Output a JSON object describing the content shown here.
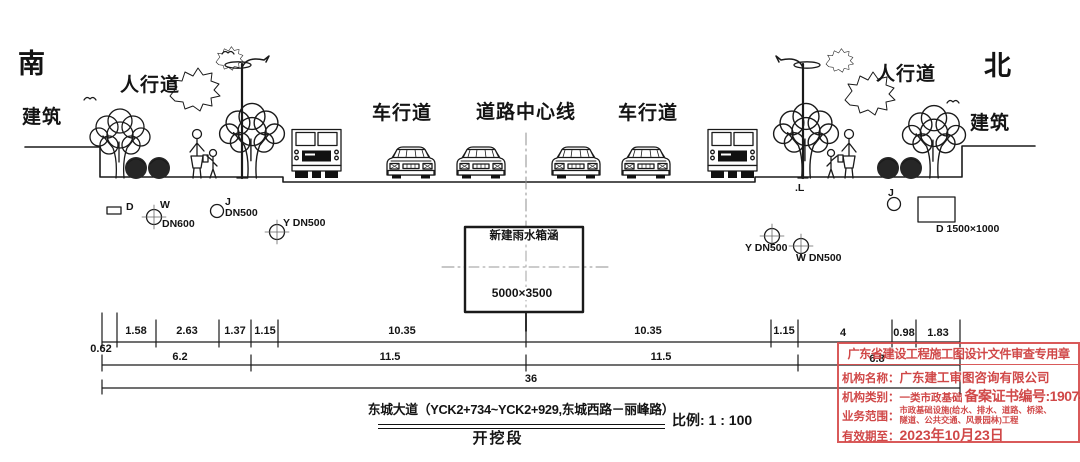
{
  "compass": {
    "south": "南",
    "north": "北"
  },
  "section_labels": {
    "building_left": "建筑",
    "sidewalk_left": "人行道",
    "roadway_left": "车行道",
    "road_centerline": "道路中心线",
    "roadway_right": "车行道",
    "sidewalk_right": "人行道",
    "building_right": "建筑"
  },
  "culvert": {
    "name": "新建雨水箱涵",
    "size": "5000×3500"
  },
  "utilities": {
    "left": {
      "d_label": "D",
      "w_label": "W",
      "w_size": "DN600",
      "j_label": "J",
      "j_size": "DN500",
      "y_label": "Y DN500"
    },
    "right": {
      "l_label": ".L",
      "y_label": "Y DN500",
      "w_label": "W DN500",
      "j_label": "J",
      "d_label": "D 1500×1000"
    }
  },
  "dimensions": {
    "row1": [
      "0.62",
      "1.58",
      "2.63",
      "1.37",
      "1.15",
      "10.35",
      "10.35",
      "1.15",
      "4",
      "0.98",
      "1.83"
    ],
    "row2": [
      "6.2",
      "11.5",
      "11.5",
      "6.8"
    ],
    "row3": [
      "36"
    ]
  },
  "title_block": {
    "title": "东城大道（YCK2+734~YCK2+929,东城西路－丽峰路）",
    "subtitle": "开挖段",
    "scale": "比例: 1 : 100"
  },
  "stamp": {
    "title": "广东省建设工程施工图设计文件审查专用章",
    "org_label": "机构名称：",
    "org_value": "广东建工审图咨询有限公司",
    "class_label": "机构类别：",
    "class_value": "一类市政基础",
    "cert_value": "备案证书编号:19074",
    "scope_label": "业务范围：",
    "scope_line1": "市政基础设施(给水、排水、道路、桥梁、",
    "scope_line2": "隧道、公共交通、风景园林)工程",
    "valid_label": "有效期至：",
    "valid_value": "2023年10月23日"
  }
}
